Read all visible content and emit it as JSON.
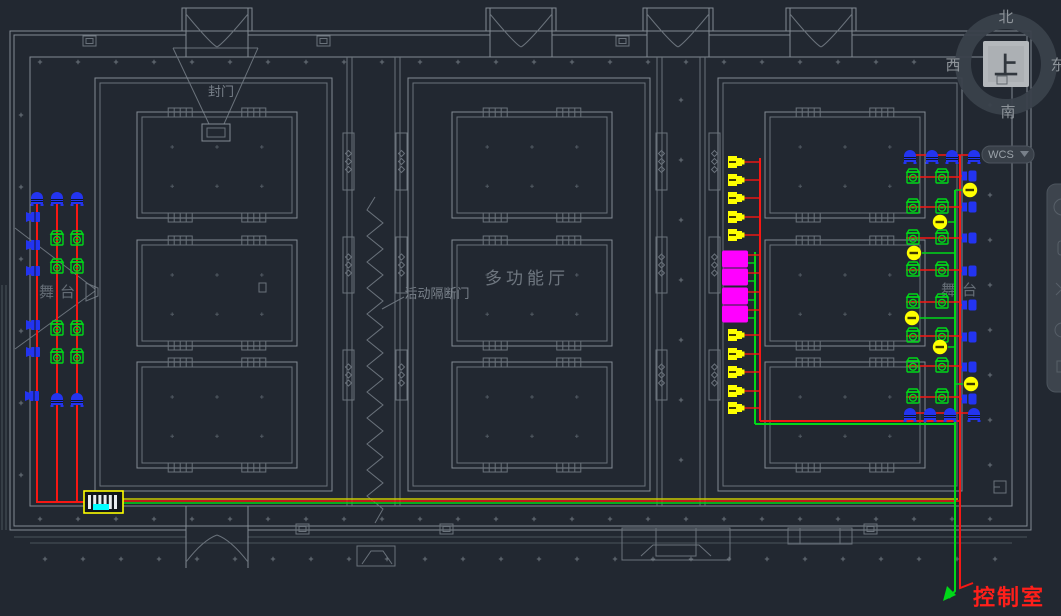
{
  "viewcube": {
    "top": "上",
    "north": "北",
    "south": "南",
    "west": "西",
    "east": "东"
  },
  "wcs": {
    "label": "WCS"
  },
  "navbar": {
    "icons": [
      "navigation-wheel-icon",
      "pan-icon",
      "zoom-icon",
      "orbit-icon",
      "show-motion-icon"
    ]
  },
  "labels": {
    "seal_door": "封门",
    "partition": "活动隔断门",
    "hall": "多功能厅",
    "stage_left": "舞台",
    "stage_right": "舞台",
    "control_room": "控制室"
  },
  "drawing": {
    "palette": {
      "red": "#f71713",
      "green": "#00d818",
      "yellow": "#ffff00",
      "olive": "#c9c900",
      "magenta": "#ff00ff",
      "blue": "#2334f0",
      "cyan": "#00ffff",
      "wall": "#828a93"
    },
    "rooms": [
      [
        95,
        78,
        237,
        413
      ],
      [
        408,
        78,
        242,
        413
      ],
      [
        718,
        78,
        244,
        413
      ]
    ],
    "coffers": [
      [
        137,
        112,
        160,
        106
      ],
      [
        137,
        240,
        160,
        106
      ],
      [
        137,
        362,
        160,
        106
      ],
      [
        452,
        112,
        160,
        106
      ],
      [
        452,
        240,
        160,
        106
      ],
      [
        452,
        362,
        160,
        106
      ],
      [
        765,
        112,
        160,
        106
      ],
      [
        765,
        240,
        160,
        106
      ],
      [
        765,
        362,
        160,
        106
      ]
    ],
    "top_door_centers": [
      217,
      521,
      678,
      821
    ],
    "bottom_door_centers": [
      217
    ],
    "rack": {
      "x": 84,
      "y": 491,
      "w": 39,
      "h": 22
    },
    "cables": [
      {
        "c": "red",
        "pts": [
          [
            37,
            196
          ],
          [
            37,
            502
          ]
        ]
      },
      {
        "c": "red",
        "pts": [
          [
            57,
            196
          ],
          [
            57,
            502
          ]
        ]
      },
      {
        "c": "red",
        "pts": [
          [
            77,
            196
          ],
          [
            77,
            502
          ]
        ]
      },
      {
        "c": "red",
        "pts": [
          [
            36,
            502
          ],
          [
            85,
            502
          ]
        ]
      },
      {
        "c": "olive",
        "pts": [
          [
            122,
            499
          ],
          [
            958,
            499
          ]
        ],
        "w": 1.6
      },
      {
        "c": "red",
        "pts": [
          [
            122,
            501
          ],
          [
            960,
            501
          ]
        ],
        "w": 1.6
      },
      {
        "c": "green",
        "pts": [
          [
            122,
            503
          ],
          [
            955,
            503
          ]
        ],
        "w": 1.6
      },
      {
        "c": "red",
        "pts": [
          [
            960,
            155
          ],
          [
            960,
            421
          ]
        ]
      },
      {
        "c": "red",
        "pts": [
          [
            760,
            158
          ],
          [
            760,
            421
          ]
        ]
      },
      {
        "c": "red",
        "pts": [
          [
            760,
            421
          ],
          [
            960,
            421
          ]
        ]
      },
      {
        "c": "red",
        "pts": [
          [
            960,
            421
          ],
          [
            960,
            588
          ],
          [
            973,
            583
          ]
        ]
      },
      {
        "c": "green",
        "pts": [
          [
            955,
            190
          ],
          [
            955,
            424
          ]
        ]
      },
      {
        "c": "green",
        "pts": [
          [
            755,
            252
          ],
          [
            755,
            424
          ]
        ]
      },
      {
        "c": "green",
        "pts": [
          [
            755,
            424
          ],
          [
            955,
            424
          ]
        ]
      },
      {
        "c": "green",
        "pts": [
          [
            955,
            424
          ],
          [
            955,
            591
          ],
          [
            949,
            598
          ]
        ]
      },
      {
        "c": "red",
        "pts": [
          [
            905,
            155
          ],
          [
            978,
            155
          ]
        ],
        "w": 1.4
      },
      {
        "c": "red",
        "pts": [
          [
            905,
            413
          ],
          [
            978,
            413
          ]
        ],
        "w": 1.4
      }
    ],
    "devices": {
      "left_top_domes": [
        [
          37,
          196
        ],
        [
          57,
          196
        ],
        [
          77,
          196
        ]
      ],
      "left_bottom_domes": [
        [
          57,
          397
        ],
        [
          77,
          397
        ]
      ],
      "left_side_speakers": [
        [
          34,
          217
        ],
        [
          34,
          245
        ],
        [
          34,
          271
        ],
        [
          34,
          325
        ],
        [
          34,
          352
        ],
        [
          33,
          396
        ]
      ],
      "left_cameras": [
        [
          57,
          239
        ],
        [
          77,
          239
        ],
        [
          57,
          267
        ],
        [
          77,
          267
        ],
        [
          57,
          329
        ],
        [
          77,
          329
        ],
        [
          57,
          357
        ],
        [
          77,
          357
        ]
      ],
      "horn_x": 736,
      "horn_trunk_x": 760,
      "horns_top": [
        162,
        180,
        198,
        217,
        235
      ],
      "horns_bottom": [
        335,
        354,
        372,
        391,
        408
      ],
      "magenta_x": 735,
      "magenta_red_x": 760,
      "magenta_green_x": 755,
      "magenta_rows": [
        259,
        277,
        296,
        314
      ],
      "cam_xs": [
        913,
        942
      ],
      "cam_rows": [
        177,
        207,
        238,
        270,
        302,
        336,
        366,
        397
      ],
      "cam_line": [
        906,
        960
      ],
      "wall_speaker_x": 970,
      "wall_speakers": [
        176,
        207,
        238,
        271,
        305,
        337,
        367,
        399
      ],
      "dome_cams": [
        [
          970,
          190
        ],
        [
          940,
          222
        ],
        [
          914,
          253
        ],
        [
          912,
          318
        ],
        [
          940,
          347
        ],
        [
          971,
          384
        ]
      ],
      "dome_trunk_x": 955,
      "top_row": {
        "y": 154,
        "xs": [
          910,
          932,
          952,
          974
        ]
      },
      "bottom_row": {
        "y": 412,
        "xs": [
          910,
          930,
          950,
          974
        ]
      }
    }
  }
}
